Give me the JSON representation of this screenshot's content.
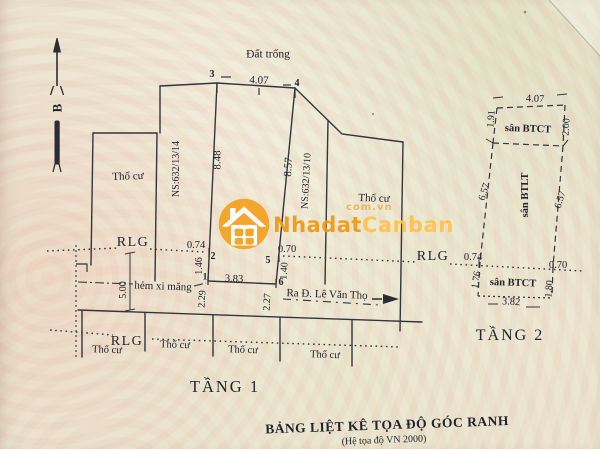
{
  "colors": {
    "ink": "#32323d",
    "orange": "#f59f1c",
    "orange_light": "#ffc24b",
    "paper": "#efead9"
  },
  "watermark": {
    "brand_a": "Nhadat",
    "brand_b": "Canban",
    "domain": "com.vn"
  },
  "plan": {
    "north_letter": "B",
    "empty_land": "Đất trống",
    "residential": "Thổ cư",
    "alley": "hẻm xi măng",
    "street": "Ra Đ. Lê Văn Thọ",
    "boundary": "RLG",
    "house_left": "NS:632/13/14",
    "house_right": "NS:632/13/10"
  },
  "floor1": {
    "title": "TẦNG 1",
    "points": {
      "p1": "1",
      "p2": "2",
      "p3": "3",
      "p4": "4",
      "p5": "5",
      "p6": "6"
    },
    "dims": {
      "top": "4.07",
      "left": "8.48",
      "right": "8.57",
      "rlg_left": "0.74",
      "rlg_right": "0.70",
      "lower_left": "1.46",
      "lower_right": "1.40",
      "bottom": "3.83",
      "alley_left": "2.29",
      "alley_right": "2.27",
      "alley_width": "5.00"
    }
  },
  "floor2": {
    "title": "TẦNG 2",
    "rooms": {
      "top": "sân BTCT",
      "middle": "sân BTLT",
      "bottom": "sân BTCT"
    },
    "dims": {
      "top": "4.07",
      "top_left": "1.91",
      "top_right": "2.00",
      "mid_left": "6.57",
      "mid_right": "6.57",
      "rlg_left": "0.74",
      "rlg_right": "0.70",
      "bottom_left": "1.76",
      "bottom_right": "1.80",
      "bottom": "3.82"
    }
  },
  "footer": {
    "title": "BẢNG LIỆT KÊ TỌA ĐỘ GÓC RANH",
    "subtitle": "(Hệ tọa độ VN 2000)"
  }
}
